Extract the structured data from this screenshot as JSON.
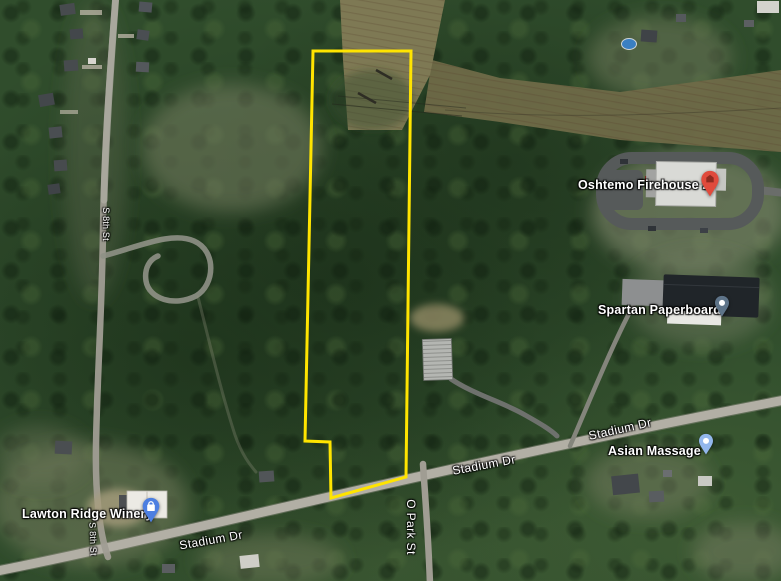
{
  "map": {
    "view": "satellite",
    "parcel": {
      "stroke_color": "#FFE400",
      "description": "highlighted property boundary"
    },
    "places": [
      {
        "name": "Oshtemo Firehouse 2",
        "pin_color": "#E04A3C",
        "pin_glyph": "building-icon",
        "pin_glyph_color": "#8F2A1F"
      },
      {
        "name": "Spartan Paperboard",
        "pin_color": "#5E7489",
        "pin_glyph": "dot",
        "pin_glyph_color": "#FFFFFF"
      },
      {
        "name": "Asian Massage",
        "pin_color": "#93B7EC",
        "pin_glyph": "dot",
        "pin_glyph_color": "#FFFFFF"
      },
      {
        "name": "Lawton Ridge Winery",
        "pin_color": "#4D7FE1",
        "pin_glyph": "shopping-bag-icon",
        "pin_glyph_color": "#FFFFFF"
      }
    ],
    "road_labels": [
      {
        "text": "Stadium Dr"
      },
      {
        "text": "Stadium Dr"
      },
      {
        "text": "Stadium Dr"
      },
      {
        "text": "O Park St"
      },
      {
        "text": "S 8th St"
      },
      {
        "text": "S 8th St"
      }
    ],
    "colors": {
      "forest": "#304D2C",
      "field_corridor": "#7E7954",
      "road": "#B2AFA5"
    }
  }
}
